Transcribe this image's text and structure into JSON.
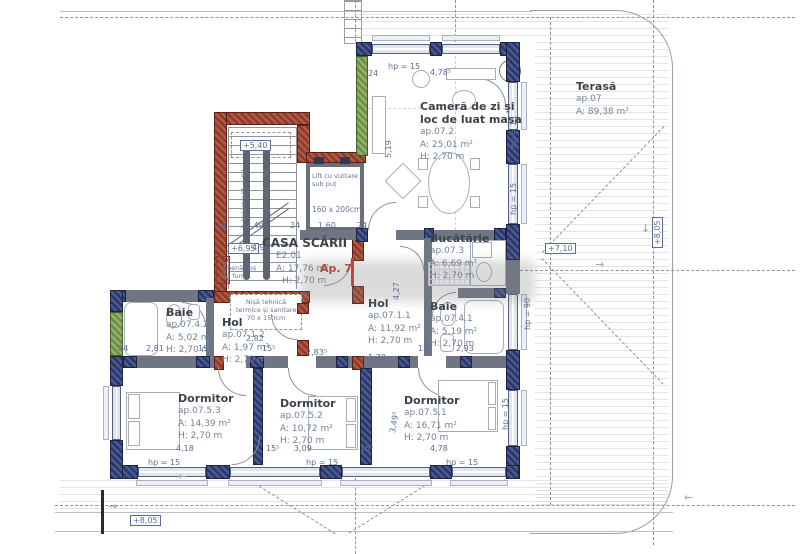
{
  "colors": {
    "wall_gray": "#6f7583",
    "pier_navy": "#2c3763",
    "pier_navy_lt": "#4a5a96",
    "wall_red": "#8e3a2b",
    "wall_red_lt": "#b05a45",
    "wall_green": "#6d8d4a",
    "wall_green_lt": "#93b06c",
    "dim_text": "#5c6d94",
    "room_title": "#3e434b",
    "room_info": "#76809a",
    "accent_red": "#c23b2c"
  },
  "apartment_label": "Ap. 7",
  "rooms": {
    "living": {
      "name1": "Cameră de zi și",
      "name2": "loc de luat masa",
      "id": "ap.07.2",
      "area": "A: 25,01 m²",
      "height": "H: 2,70 m"
    },
    "terrace": {
      "name": "Terasă",
      "id": "ap.07",
      "area": "A: 89,38 m²"
    },
    "staircase": {
      "name": "CASA SCĂRII",
      "id": "E2.01",
      "area": "A: 17,76 m²",
      "height": "H: 2,70 m"
    },
    "kitchen": {
      "name": "Bucătărie",
      "id": "ap.07.3",
      "area": "A: 6,69 m²",
      "height": "H: 2,70 m"
    },
    "bath_right": {
      "name": "Baie",
      "id": "ap.07.4.1",
      "area": "A: 5,19 m²",
      "height": "H: 2,70 m"
    },
    "bath_left": {
      "name": "Baie",
      "id": "ap.07.4.2",
      "area": "A: 5,02 m²",
      "height": "H: 2,70 m"
    },
    "hall_small": {
      "name": "Hol",
      "id": "ap.07.1.2",
      "area": "A: 1,97 m²",
      "height": "H: 2,70 m"
    },
    "hall_main": {
      "name": "Hol",
      "id": "ap.07.1.1",
      "area": "A: 11,92 m²",
      "height": "H: 2,70 m"
    },
    "bedroom_left": {
      "name": "Dormitor",
      "id": "ap.07.5.3",
      "area": "A: 14,39 m²",
      "height": "H: 2,70 m"
    },
    "bedroom_mid": {
      "name": "Dormitor",
      "id": "ap.07.5.2",
      "area": "A: 10,72 m²",
      "height": "H: 2,70 m"
    },
    "bedroom_right": {
      "name": "Dormitor",
      "id": "ap.07.5.1",
      "area": "A: 16,71 m²",
      "height": "H: 2,70 m"
    }
  },
  "lift": {
    "line1": "Lift cu vizitare",
    "line2": "sub puț",
    "size": "160 x 200cm"
  },
  "niche": {
    "line1": "Nișă tehnică",
    "line2": "termice și sanitare",
    "line3": "70 x 150cm"
  },
  "chimney": {
    "line1": "Ghenă coș",
    "line2": "de fum"
  },
  "levels": {
    "stair": "+5,40",
    "floor": "+6,95",
    "terrace": "+7,10",
    "roof_right": "+8,05",
    "roof_bottom": "+8,05"
  },
  "balustrade": "h balustradă = 90",
  "dims": [
    {
      "t": "24",
      "x": 368,
      "y": 69
    },
    {
      "t": "hp = 15",
      "x": 388,
      "y": 62
    },
    {
      "t": "4,78⁵",
      "x": 430,
      "y": 68
    },
    {
      "t": "5,19",
      "x": 384,
      "y": 158,
      "r": -90
    },
    {
      "t": "hp = 15",
      "x": 509,
      "y": 148,
      "r": -90
    },
    {
      "t": "hp = 15",
      "x": 509,
      "y": 215,
      "r": -90
    },
    {
      "t": "hp = 90",
      "x": 523,
      "y": 330,
      "r": -90
    },
    {
      "t": "hp = 15",
      "x": 501,
      "y": 430,
      "r": -90
    },
    {
      "t": "24",
      "x": 216,
      "y": 221
    },
    {
      "t": "2,49",
      "x": 246,
      "y": 221
    },
    {
      "t": "24",
      "x": 290,
      "y": 221
    },
    {
      "t": "1,60",
      "x": 318,
      "y": 221
    },
    {
      "t": "24",
      "x": 357,
      "y": 221
    },
    {
      "t": "4,96",
      "x": 252,
      "y": 243
    },
    {
      "t": "4,27",
      "x": 392,
      "y": 300,
      "r": -90
    },
    {
      "t": "24",
      "x": 118,
      "y": 344
    },
    {
      "t": "2,81",
      "x": 146,
      "y": 344
    },
    {
      "t": "15⁵",
      "x": 198,
      "y": 344
    },
    {
      "t": "2,82",
      "x": 246,
      "y": 334
    },
    {
      "t": "15⁵",
      "x": 262,
      "y": 344
    },
    {
      "t": "2,83⁵",
      "x": 306,
      "y": 348
    },
    {
      "t": "1,70",
      "x": 368,
      "y": 353
    },
    {
      "t": "15⁵",
      "x": 418,
      "y": 344
    },
    {
      "t": "2,93",
      "x": 456,
      "y": 344
    },
    {
      "t": "4,18",
      "x": 176,
      "y": 444
    },
    {
      "t": "15⁵",
      "x": 266,
      "y": 444
    },
    {
      "t": "3,09",
      "x": 294,
      "y": 444
    },
    {
      "t": "15⁵",
      "x": 360,
      "y": 444
    },
    {
      "t": "4,78",
      "x": 430,
      "y": 444
    },
    {
      "t": "3,49⁵",
      "x": 388,
      "y": 432,
      "r": -80
    },
    {
      "t": "hp = 15",
      "x": 148,
      "y": 458
    },
    {
      "t": "hp = 15",
      "x": 306,
      "y": 458
    },
    {
      "t": "hp = 15",
      "x": 446,
      "y": 458
    }
  ]
}
